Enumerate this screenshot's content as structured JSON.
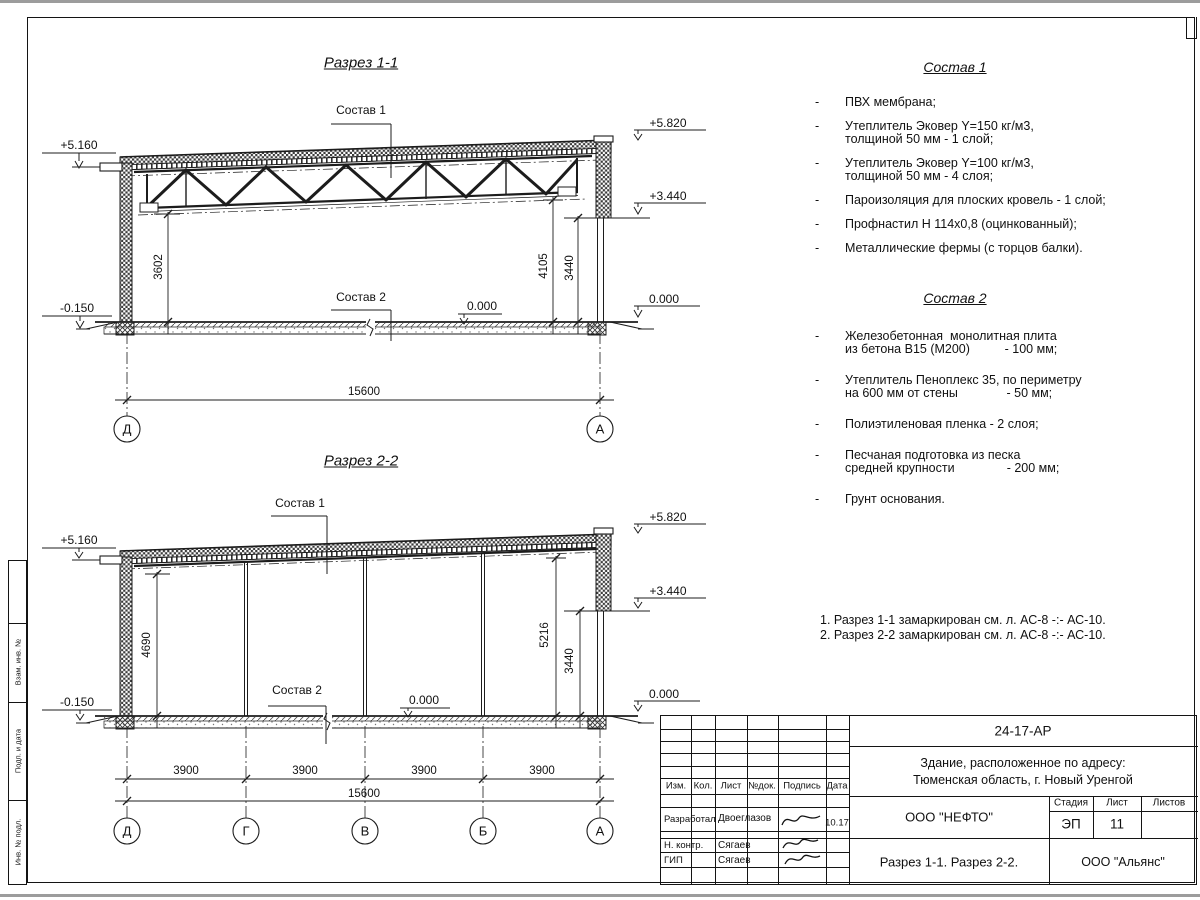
{
  "section1": {
    "title": "Разрез 1-1",
    "composition1_label": "Состав 1",
    "composition2_label": "Состав 2",
    "elevations": {
      "left_top": "+5.160",
      "left_ground": "-0.150",
      "right_top": "+5.820",
      "right_mid": "+3.440",
      "right_floor": "0.000",
      "inner_floor": "0.000"
    },
    "dimensions": {
      "left_clear": "3602",
      "right_clear": "4105",
      "right_mid": "3440",
      "span": "15600"
    },
    "axes": [
      "Д",
      "А"
    ]
  },
  "section2": {
    "title": "Разрез 2-2",
    "composition1_label": "Состав 1",
    "composition2_label": "Состав 2",
    "elevations": {
      "left_top": "+5.160",
      "left_ground": "-0.150",
      "right_top": "+5.820",
      "right_mid": "+3.440",
      "right_floor": "0.000",
      "inner_floor": "0.000"
    },
    "dimensions": {
      "left_clear": "4690",
      "right_clear": "5216",
      "right_mid": "3440",
      "bays": [
        "3900",
        "3900",
        "3900",
        "3900"
      ],
      "span": "15600"
    },
    "axes": [
      "Д",
      "Г",
      "В",
      "Б",
      "А"
    ]
  },
  "composition1": {
    "title": "Состав 1",
    "bullet": "-",
    "items": [
      "ПВХ мембрана;",
      "Утеплитель Эковер Y=150 кг/м3,\nтолщиной 50 мм - 1 слой;",
      "Утеплитель Эковер Y=100 кг/м3,\nтолщиной 50 мм - 4 слоя;",
      "Пароизоляция для плоских кровель - 1 слой;",
      "Профнастил Н 114х0,8 (оцинкованный);",
      "Металлические фермы (с торцов балки)."
    ]
  },
  "composition2": {
    "title": "Состав 2",
    "bullet": "-",
    "items": [
      "Железобетонная  монолитная плита\nиз бетона В15 (М200)          - 100 мм;",
      "Утеплитель Пеноплекс 35, по периметру\nна 600 мм от стены              - 50 мм;",
      "Полиэтиленовая пленка - 2 слоя;",
      "Песчаная подготовка из песка\nсредней крупности               - 200 мм;",
      "Грунт основания."
    ]
  },
  "notes": {
    "line1": "1. Разрез 1-1 замаркирован см. л. АС-8 -:- АС-10.",
    "line2": "2. Разрез 2-2 замаркирован см. л. АС-8 -:- АС-10."
  },
  "stamp": {
    "doc_number": "24-17-АР",
    "object_line1": "Здание, расположенное по адресу:",
    "object_line2": "Тюменская область, г. Новый Уренгой",
    "cols": {
      "izm": "Изм.",
      "kol": "Кол.",
      "list": "Лист",
      "ndok": "№док.",
      "podpis": "Подпись",
      "data": "Дата"
    },
    "rows": [
      {
        "role": "Разработал",
        "name": "Двоеглазов",
        "date": "10.17"
      },
      {
        "role": "Н. контр.",
        "name": "Сягаев",
        "date": ""
      },
      {
        "role": "ГИП",
        "name": "Сягаев",
        "date": ""
      }
    ],
    "company": "ООО \"НЕФТО\"",
    "stage_label": "Стадия",
    "sheet_label": "Лист",
    "sheets_label": "Листов",
    "stage": "ЭП",
    "sheet": "11",
    "sheets": "",
    "sheet_title": "Разрез 1-1. Разрез 2-2.",
    "org": "ООО \"Альянс\""
  },
  "side_strip": {
    "labels": [
      "Взам. инв. №",
      "Подп. и дата",
      "Инв. № подл."
    ]
  }
}
